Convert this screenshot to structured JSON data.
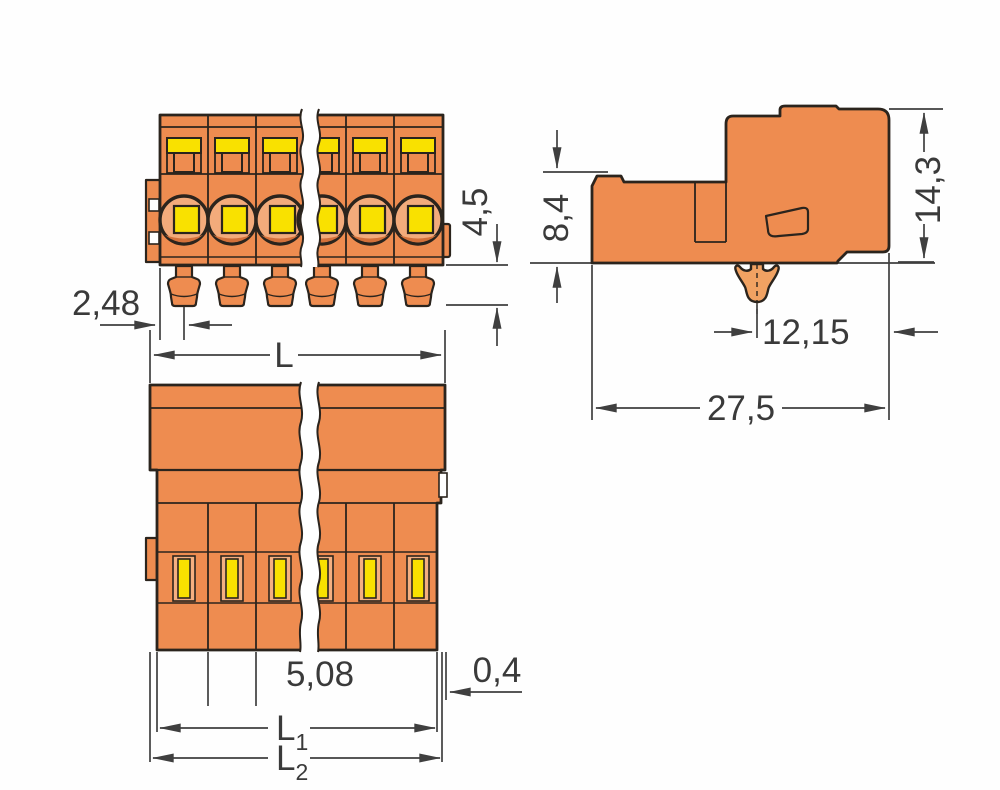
{
  "drawing": {
    "title": "connector-dimension-drawing",
    "views": {
      "front": "front-view",
      "top": "top-view",
      "side": "side-view"
    },
    "colors": {
      "body_orange": "#EE8C50",
      "recess_peach": "#F3AB7B",
      "recess_shadow": "#D4713A",
      "contact_yellow": "#F9E100",
      "slot_frame": "#F5AF80",
      "foot_orange": "#F1A262",
      "outline": "#2B241D",
      "dimension": "#3F3F3F",
      "background": "#FFFFFF"
    },
    "dims": {
      "front": {
        "pin_offset": "2,48",
        "pin_length": "4,5"
      },
      "top": {
        "length": "L",
        "pitch": "5,08",
        "tab": "0,4",
        "l1": {
          "base": "L",
          "sub": "1"
        },
        "l2": {
          "base": "L",
          "sub": "2"
        }
      },
      "side": {
        "front_height": "8,4",
        "total_height": "14,3",
        "foot_to_edge": "12,15",
        "depth": "27,5"
      }
    }
  }
}
